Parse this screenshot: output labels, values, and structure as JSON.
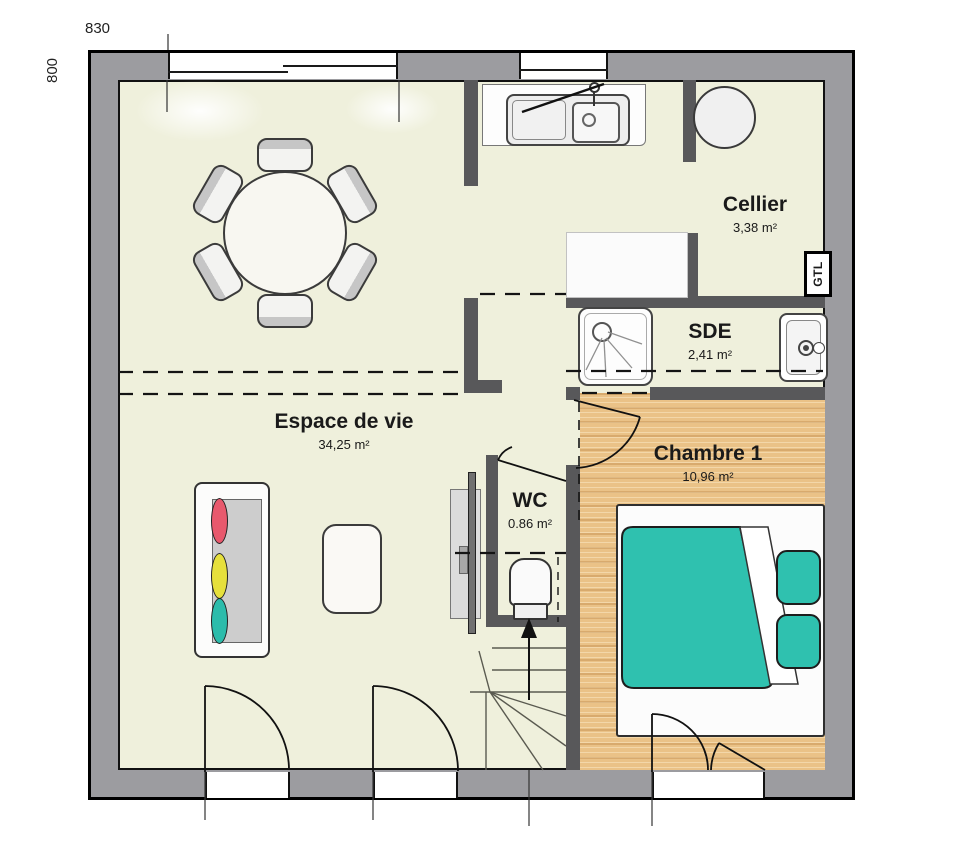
{
  "plan": {
    "title": "floor-plan-ground-level",
    "dimensions": {
      "top_width": "830",
      "left_height": "800"
    },
    "rooms": {
      "espace_de_vie": {
        "name": "Espace de vie",
        "area": "34,25 m²"
      },
      "cellier": {
        "name": "Cellier",
        "area": "3,38 m²"
      },
      "sde": {
        "name": "SDE",
        "area": "2,41 m²"
      },
      "chambre1": {
        "name": "Chambre 1",
        "area": "10,96 m²"
      },
      "wc": {
        "name": "WC",
        "area": "0.86 m²"
      }
    },
    "annotations": {
      "gtl": "GTL"
    },
    "colors": {
      "exterior_wall": "#9c9ca0",
      "interior_wall": "#58585a",
      "floor": "#eff0dc",
      "bedroom_wood": "#eac287",
      "bed_teal": "#2fc1af",
      "cushion_red": "#e8596d",
      "cushion_yellow": "#e6e03c",
      "cushion_teal": "#2cbcab"
    }
  }
}
